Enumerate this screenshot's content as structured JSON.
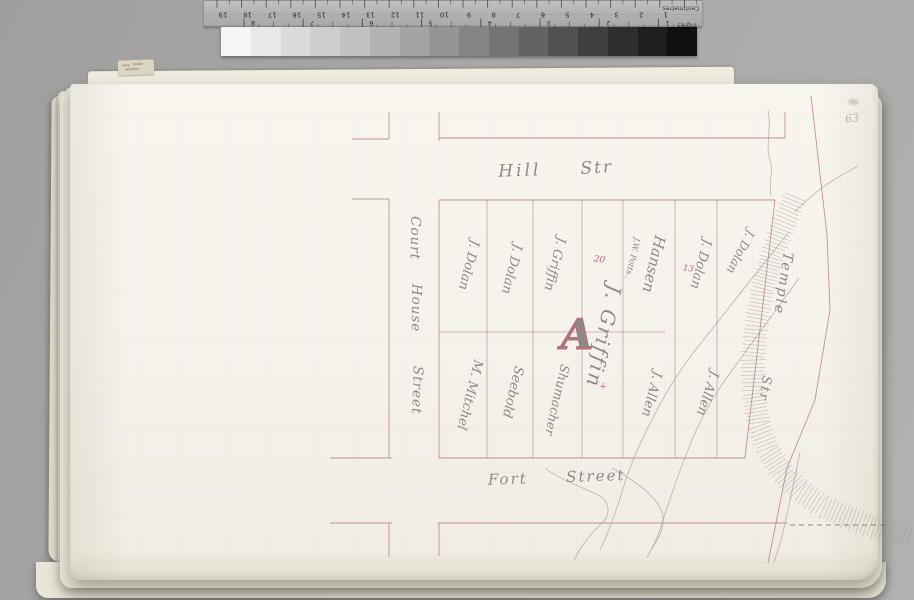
{
  "photo": {
    "ruler": {
      "cm_numbers": [
        "19",
        "18",
        "17",
        "16",
        "15",
        "14",
        "13",
        "12",
        "11",
        "10",
        "9",
        "8",
        "7",
        "6",
        "5",
        "4",
        "3",
        "2",
        "1"
      ],
      "inch_numbers": [
        "8",
        "7",
        "6",
        "5",
        "4",
        "3",
        "2",
        "1"
      ],
      "cm_label": "Centimetres",
      "inch_label": "Inches"
    },
    "grayscale_steps": [
      "#f5f5f3",
      "#e9e8e6",
      "#dcdbd9",
      "#cfcecd",
      "#c2c1c0",
      "#b4b3b2",
      "#a5a4a3",
      "#969594",
      "#868584",
      "#757473",
      "#646362",
      "#525150",
      "#413f3e",
      "#302e2d",
      "#201e1d",
      "#100f0e"
    ],
    "page_number": "63"
  },
  "map": {
    "streets": {
      "hill": [
        "Hill",
        "Str"
      ],
      "fort": [
        "Fort",
        "Street"
      ],
      "court_house": [
        "Court",
        "House",
        "Street"
      ],
      "temple": [
        "Temple",
        "Str"
      ]
    },
    "lots": [
      {
        "name": "J. Dolan"
      },
      {
        "name": "J. Dolan"
      },
      {
        "name": "J. Griffin"
      },
      {
        "name": "J. Griffin"
      },
      {
        "name": "Hansen",
        "sub": "J.W. Potts.."
      },
      {
        "name": "J. Dolan"
      },
      {
        "name": "J. Dolan"
      },
      {
        "name": "M. Mitchel"
      },
      {
        "name": "Seebold"
      },
      {
        "name": "Shumacher"
      },
      {
        "name": "J. Allen"
      },
      {
        "name": "J. Allen"
      }
    ],
    "markers": {
      "district_letter": "A",
      "lot_number_20": "20",
      "lot_number_13": "13",
      "cross_mark": "+"
    },
    "colors": {
      "street_line": "#bb7e86",
      "ink": "#8d888c",
      "marker_red": "#c4646c"
    }
  }
}
